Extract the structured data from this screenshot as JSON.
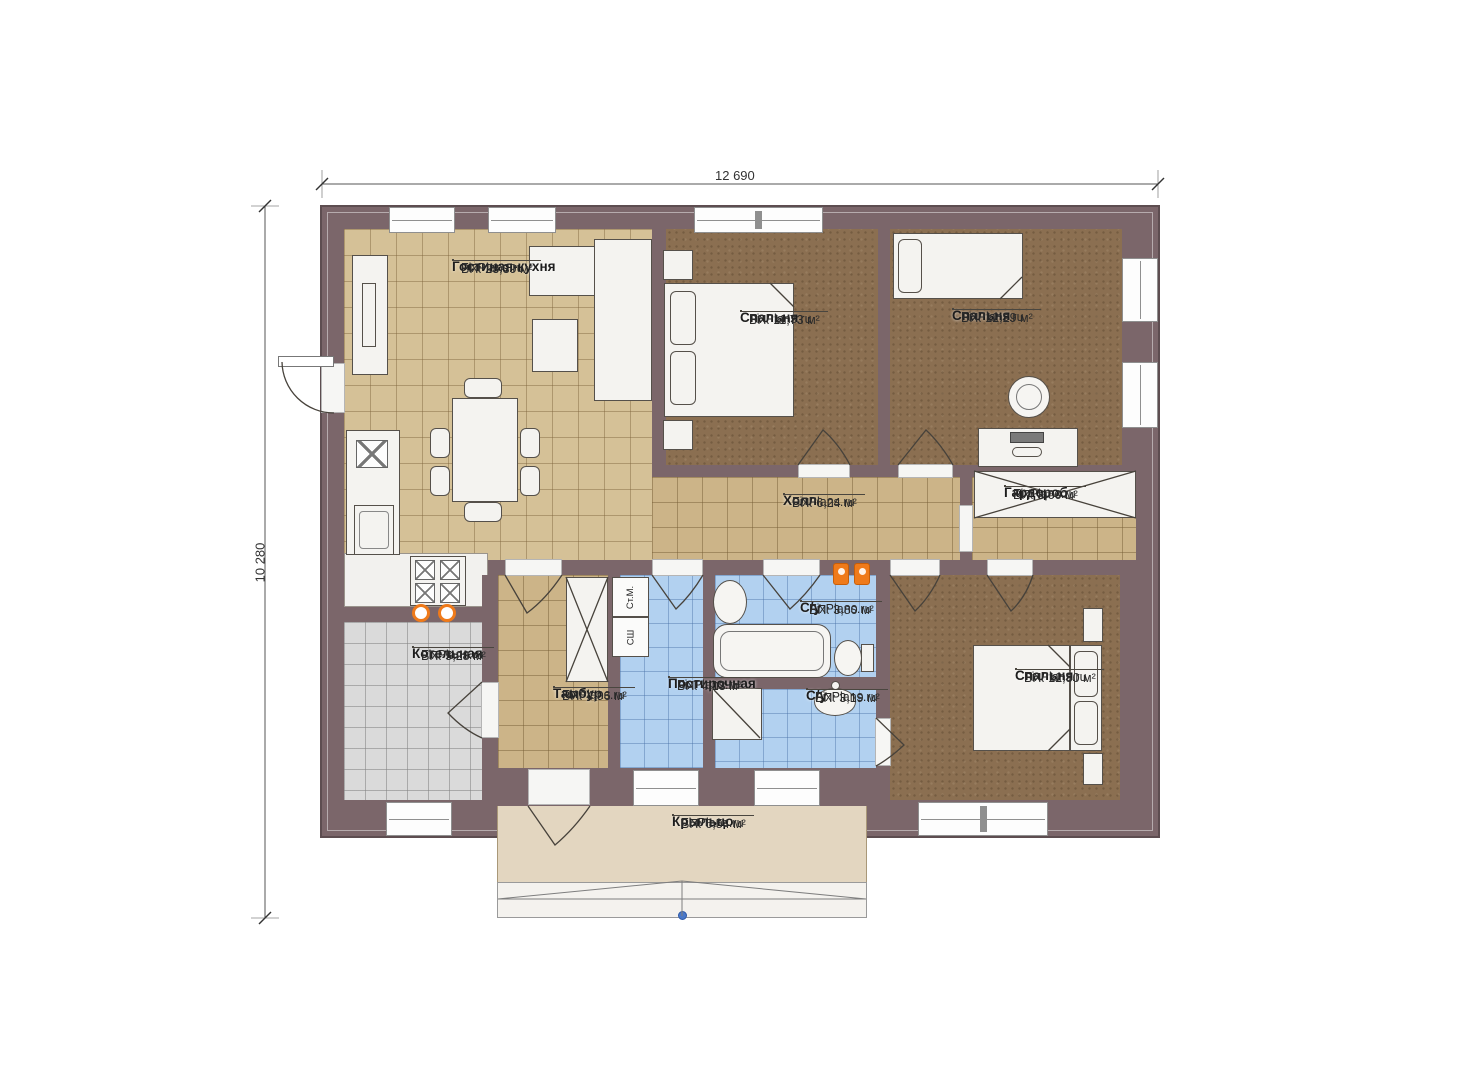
{
  "plan": {
    "title": "Floor plan",
    "dim_width": "12 690",
    "dim_height": "10 280",
    "watermark": "FixPlans.ru",
    "rooms": {
      "living": {
        "name": "Гостиная-кухня",
        "site": "FixPlans.ru",
        "area": "ВП: 23,39 м²"
      },
      "bedroom1": {
        "name": "Спальня",
        "site": "FixPlans.ru",
        "area": "ВП: 11,73 м²"
      },
      "bedroom2": {
        "name": "Спальня",
        "site": "FixPlans.ru",
        "area": "ВП: 12,29 м²"
      },
      "hall": {
        "name": "Холл",
        "site": "FixPlans.ru",
        "area": "ВП: 6,24 м²"
      },
      "wardrobe": {
        "name": "Гардероб",
        "site": "FixPlans.ru",
        "area": "ВП: 3,00 м²"
      },
      "boiler": {
        "name": "Котельная",
        "site": "FixPlans.ru",
        "area": "ВП: 5,28 м²"
      },
      "vestibule": {
        "name": "Тамбур",
        "site": "FixPlans.ru",
        "area": "ВП: 4,96 м²"
      },
      "laundry": {
        "name": "Постирочная",
        "site": "FixPlans.ru",
        "area": "ВП: 4,13 м²"
      },
      "bath1": {
        "name": "С/у",
        "site": "FixPlans.ru",
        "area": "ВП: 3,80 м²"
      },
      "bath2": {
        "name": "С/у",
        "site": "FixPlans.ru",
        "area": "ВП: 3,19 м²"
      },
      "bedroom3": {
        "name": "Спальня",
        "site": "FixPlans.ru",
        "area": "ВП: 12,80 м²"
      },
      "porch": {
        "name": "Крыльцо",
        "site": "FixPlans.ru",
        "area": "ВП: 6,54 м²"
      }
    },
    "appliances": {
      "washer": "Ст.М.",
      "dryer": "СШ"
    },
    "colors": {
      "wall": "#7b666a",
      "floor_tan": "#d5c197",
      "floor_brown": "#8b6f51",
      "floor_blue": "#b2d1f0",
      "floor_gray": "#dadada",
      "porch": "#e3d6c0",
      "accent_orange": "#ef7a1a",
      "marker_blue": "#4a78c8"
    }
  }
}
